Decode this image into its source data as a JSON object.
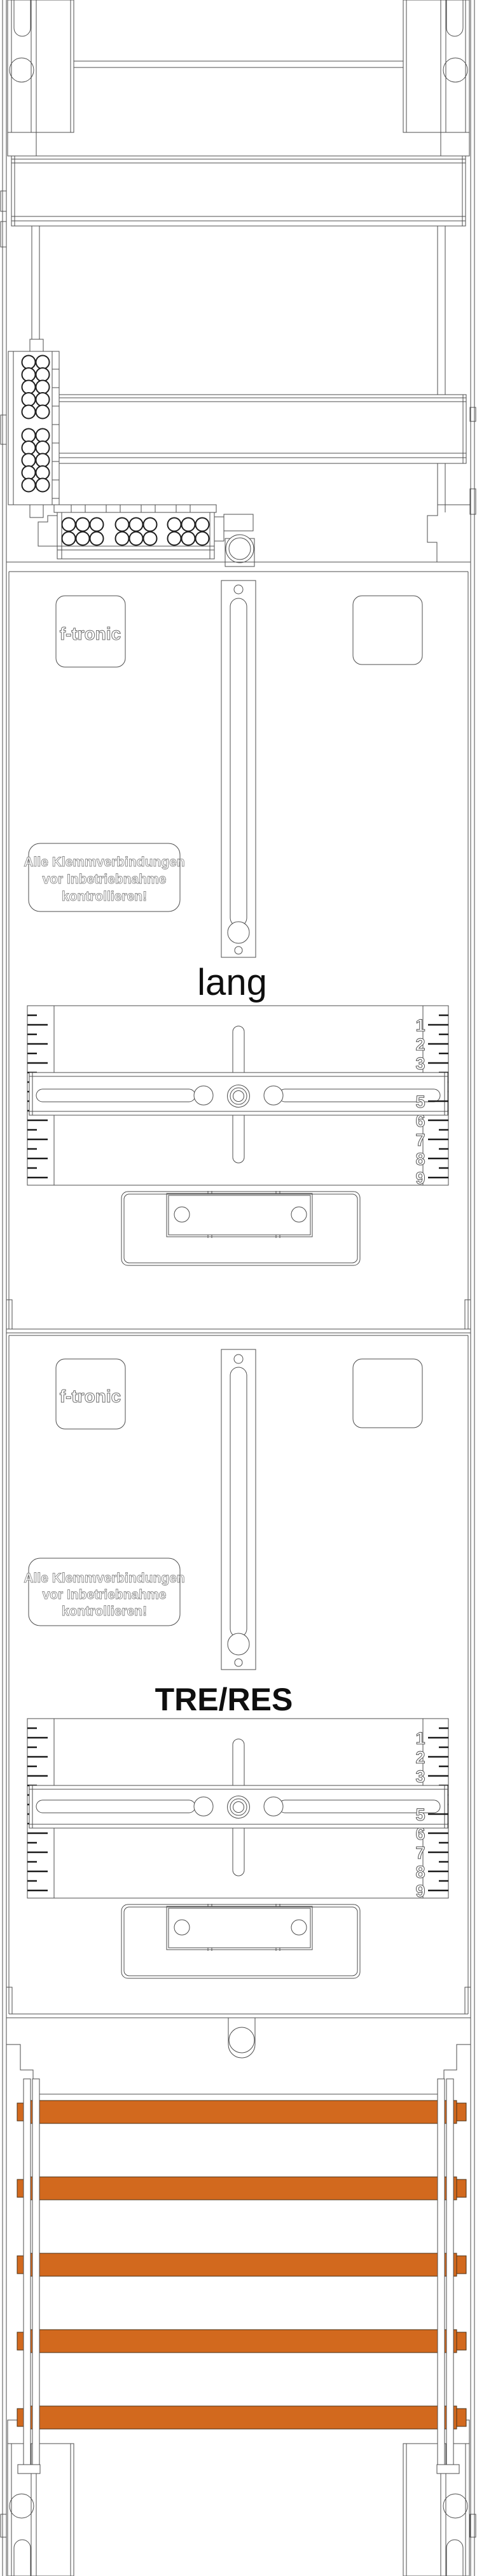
{
  "drawing": {
    "title": "f-tronic meter cabinet assembly drawing",
    "brand_logo": "f-tronic",
    "warning_label": {
      "line1": "Alle Klemmverbindungen",
      "line2": "vor Inbetriebnahme",
      "line3": "kontrollieren!"
    },
    "panel1_label": "lang",
    "panel2_label": "TRE/RES",
    "ruler_numbers": [
      "1",
      "2",
      "3",
      "4",
      "5",
      "6",
      "7",
      "8",
      "9"
    ],
    "busbar_count": 5
  },
  "colors": {
    "busbar": "#D2691E",
    "line": "#4d4d4d"
  }
}
